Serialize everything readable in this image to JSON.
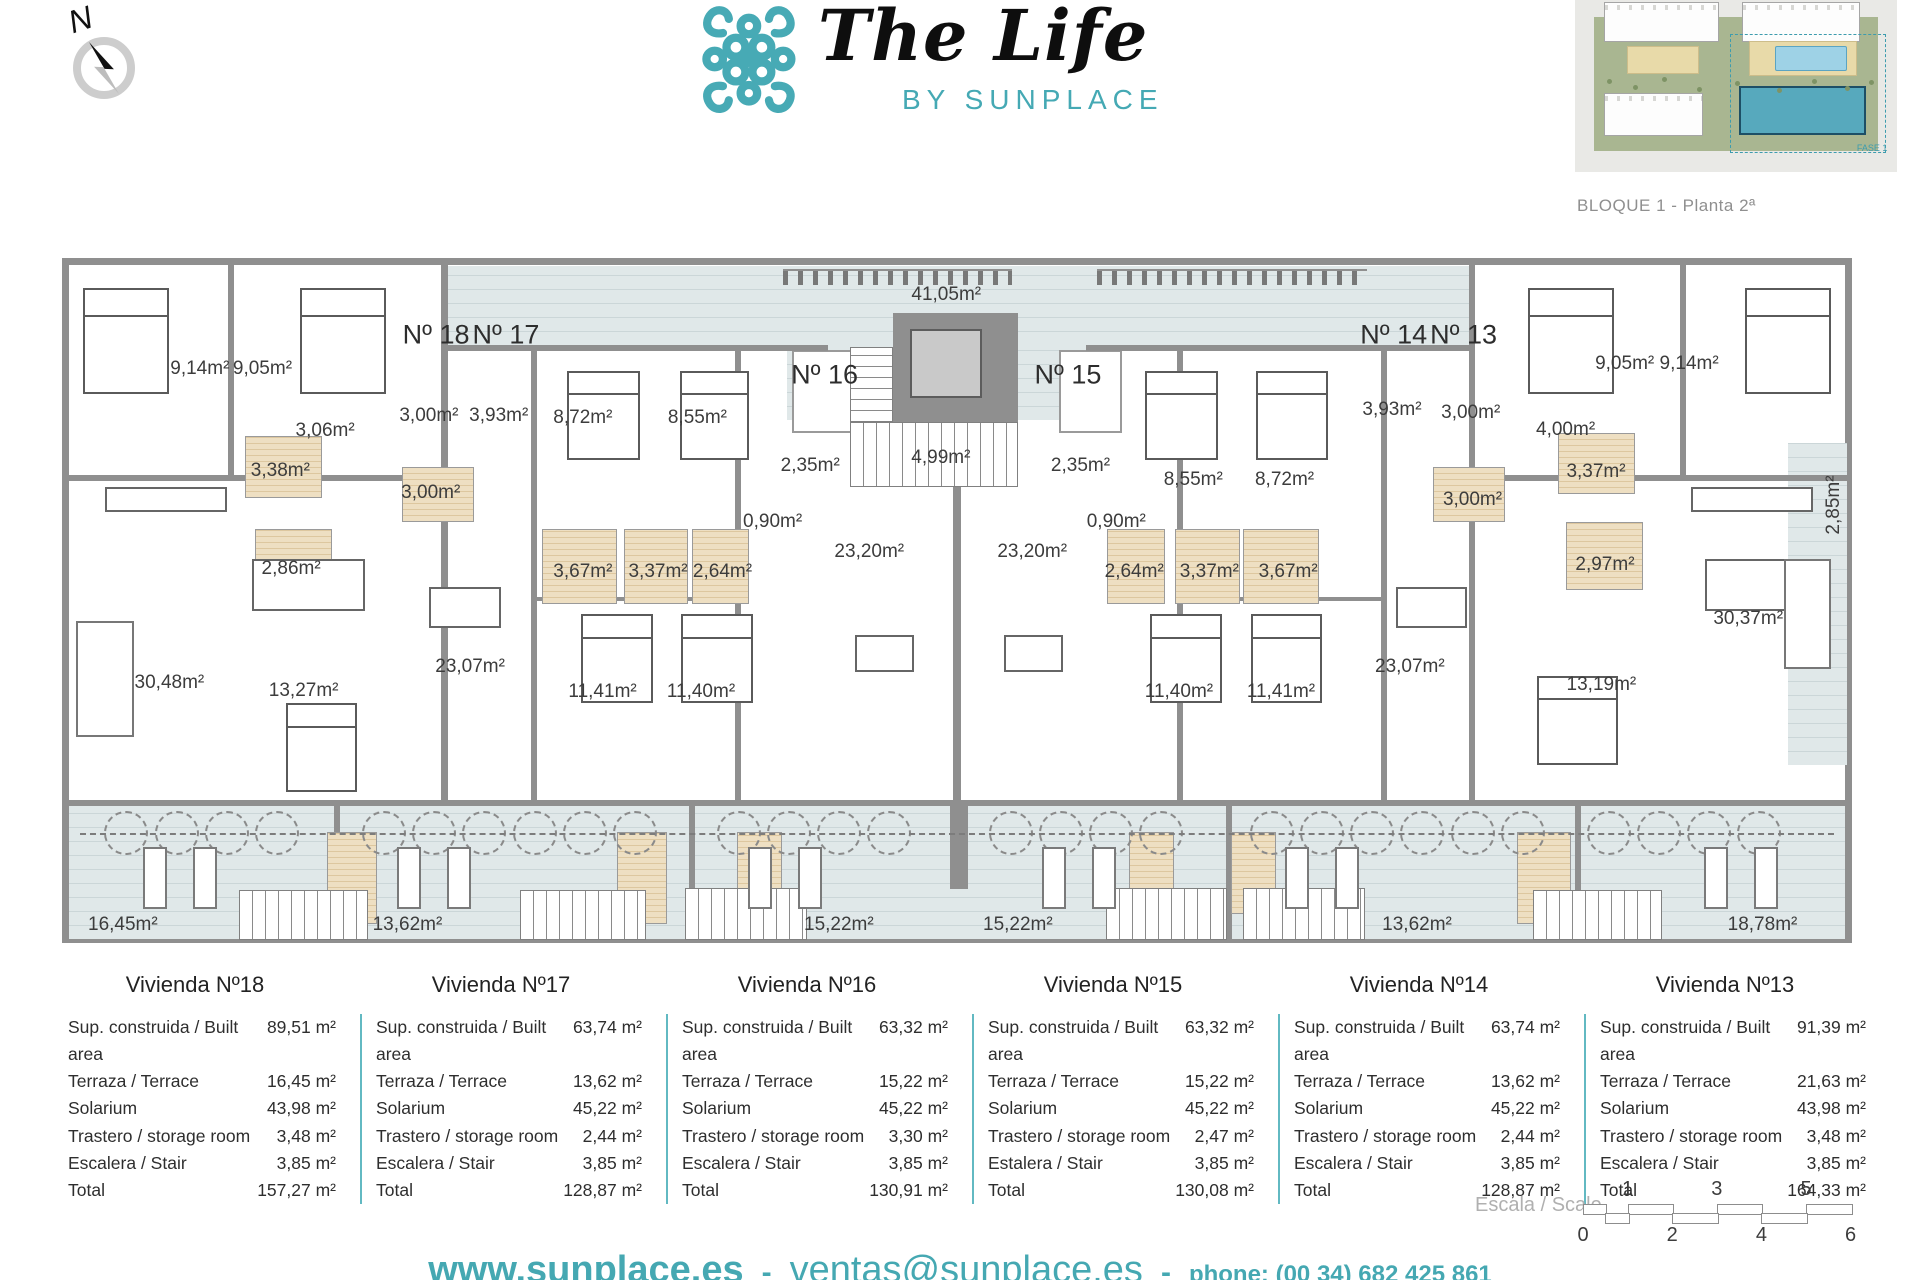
{
  "header": {
    "brand_script": "The Life",
    "brand_sub": "BY SUNPLACE",
    "compass_n": "N",
    "block_label": "BLOQUE 1 - Planta 2ª",
    "minimap_fase": "FASE 1"
  },
  "colors": {
    "accent_teal": "#45a8b2",
    "wall_gray": "#8f8f8f",
    "terrace_hatch": "#e0e8e9",
    "bathroom_beige": "#ecdcbd",
    "table_divider": "#62b9c2"
  },
  "plan": {
    "labels": [
      {
        "t": "Nº 18",
        "x": 20.9,
        "y": 11.2,
        "k": "apt"
      },
      {
        "t": "Nº 17",
        "x": 24.8,
        "y": 11.2,
        "k": "apt"
      },
      {
        "t": "Nº 16",
        "x": 42.6,
        "y": 17.1,
        "k": "apt"
      },
      {
        "t": "Nº 15",
        "x": 56.2,
        "y": 17.1,
        "k": "apt"
      },
      {
        "t": "Nº 14",
        "x": 74.4,
        "y": 11.2,
        "k": "apt"
      },
      {
        "t": "Nº 13",
        "x": 78.3,
        "y": 11.2,
        "k": "apt"
      },
      {
        "t": "41,05m²",
        "x": 49.4,
        "y": 5.4
      },
      {
        "t": "9,14m²",
        "x": 7.7,
        "y": 16.2
      },
      {
        "t": "9,05m²",
        "x": 11.2,
        "y": 16.2
      },
      {
        "t": "3,06m²",
        "x": 14.7,
        "y": 25.3
      },
      {
        "t": "3,00m²",
        "x": 20.5,
        "y": 23.0
      },
      {
        "t": "3,93m²",
        "x": 24.4,
        "y": 23.0
      },
      {
        "t": "8,72m²",
        "x": 29.1,
        "y": 23.4
      },
      {
        "t": "8,55m²",
        "x": 35.5,
        "y": 23.4
      },
      {
        "t": "3,38m²",
        "x": 12.2,
        "y": 31.1
      },
      {
        "t": "3,00m²",
        "x": 20.6,
        "y": 34.3
      },
      {
        "t": "2,86m²",
        "x": 12.8,
        "y": 45.4
      },
      {
        "t": "3,67m²",
        "x": 29.1,
        "y": 45.8
      },
      {
        "t": "3,37m²",
        "x": 33.3,
        "y": 45.8
      },
      {
        "t": "2,64m²",
        "x": 36.9,
        "y": 45.8
      },
      {
        "t": "0,90m²",
        "x": 39.7,
        "y": 38.5
      },
      {
        "t": "2,35m²",
        "x": 41.8,
        "y": 30.4
      },
      {
        "t": "4,99m²",
        "x": 49.1,
        "y": 29.2
      },
      {
        "t": "2,35m²",
        "x": 56.9,
        "y": 30.4
      },
      {
        "t": "0,90m²",
        "x": 58.9,
        "y": 38.5
      },
      {
        "t": "23,20m²",
        "x": 45.1,
        "y": 42.9
      },
      {
        "t": "23,20m²",
        "x": 54.2,
        "y": 42.9
      },
      {
        "t": "8,55m²",
        "x": 63.2,
        "y": 32.4
      },
      {
        "t": "8,72m²",
        "x": 68.3,
        "y": 32.4
      },
      {
        "t": "2,64m²",
        "x": 59.9,
        "y": 45.8
      },
      {
        "t": "3,37m²",
        "x": 64.1,
        "y": 45.8
      },
      {
        "t": "3,67m²",
        "x": 68.5,
        "y": 45.8
      },
      {
        "t": "3,93m²",
        "x": 74.3,
        "y": 22.2
      },
      {
        "t": "3,00m²",
        "x": 78.7,
        "y": 22.6
      },
      {
        "t": "4,00m²",
        "x": 84.0,
        "y": 25.1
      },
      {
        "t": "3,00m²",
        "x": 78.8,
        "y": 35.3
      },
      {
        "t": "3,37m²",
        "x": 85.7,
        "y": 31.2
      },
      {
        "t": "2,97m²",
        "x": 86.2,
        "y": 44.8
      },
      {
        "t": "9,05m²",
        "x": 87.3,
        "y": 15.5
      },
      {
        "t": "9,14m²",
        "x": 90.9,
        "y": 15.5
      },
      {
        "t": "2,85m²",
        "x": 99.0,
        "y": 36.0,
        "r": 1
      },
      {
        "t": "30,48m²",
        "x": 6.0,
        "y": 62.0
      },
      {
        "t": "13,27m²",
        "x": 13.5,
        "y": 63.2
      },
      {
        "t": "23,07m²",
        "x": 22.8,
        "y": 59.7
      },
      {
        "t": "11,41m²",
        "x": 30.2,
        "y": 63.4
      },
      {
        "t": "11,40m²",
        "x": 35.7,
        "y": 63.4
      },
      {
        "t": "11,40m²",
        "x": 62.4,
        "y": 63.4
      },
      {
        "t": "11,41m²",
        "x": 68.1,
        "y": 63.4
      },
      {
        "t": "23,07m²",
        "x": 75.3,
        "y": 59.7
      },
      {
        "t": "13,19m²",
        "x": 86.0,
        "y": 62.3
      },
      {
        "t": "30,37m²",
        "x": 94.2,
        "y": 52.7
      },
      {
        "t": "16,45m²",
        "x": 3.4,
        "y": 97.3
      },
      {
        "t": "13,62m²",
        "x": 19.3,
        "y": 97.3
      },
      {
        "t": "15,22m²",
        "x": 43.4,
        "y": 97.3
      },
      {
        "t": "15,22m²",
        "x": 53.4,
        "y": 97.3
      },
      {
        "t": "13,62m²",
        "x": 75.7,
        "y": 97.3
      },
      {
        "t": "18,78m²",
        "x": 95.0,
        "y": 97.3
      }
    ],
    "hatch": [
      [
        21.2,
        1.2,
        57.4,
        11.5
      ],
      [
        40.5,
        12.7,
        17.7,
        11.0
      ],
      [
        96.4,
        27.0,
        3.3,
        47.0
      ],
      [
        0.4,
        80.0,
        99.2,
        19.4
      ]
    ],
    "tickstrips": [
      [
        40.3,
        1.6,
        12.8,
        2.4
      ],
      [
        57.8,
        1.6,
        15.1,
        2.4
      ]
    ],
    "walls_v": [
      [
        21.2,
        0,
        0.34,
        79.1
      ],
      [
        9.3,
        0,
        0.3,
        31.7
      ],
      [
        90.4,
        0,
        0.3,
        31.7
      ],
      [
        26.2,
        12.7,
        0.34,
        66.4
      ],
      [
        37.6,
        12.7,
        0.34,
        66.4
      ],
      [
        62.3,
        12.7,
        0.34,
        66.4
      ],
      [
        73.7,
        12.7,
        0.34,
        66.4
      ],
      [
        78.6,
        0,
        0.34,
        79.1
      ],
      [
        49.8,
        27.0,
        0.4,
        52.1
      ],
      [
        15.2,
        79.1,
        0.34,
        20.9
      ],
      [
        35.0,
        79.1,
        0.34,
        20.9
      ],
      [
        65.0,
        79.1,
        0.34,
        20.9
      ],
      [
        84.5,
        79.1,
        0.34,
        20.9
      ],
      [
        49.6,
        79.1,
        1.0,
        13.0
      ]
    ],
    "walls_h": [
      [
        21.2,
        12.7,
        21.6,
        0.9
      ],
      [
        57.2,
        12.7,
        21.75,
        0.9
      ],
      [
        0,
        31.7,
        21.2,
        0.9
      ],
      [
        78.6,
        31.7,
        21.4,
        0.9
      ],
      [
        0,
        79.1,
        100,
        0.9
      ],
      [
        26.2,
        49.5,
        11.4,
        0.6
      ],
      [
        62.3,
        49.5,
        11.4,
        0.6
      ]
    ],
    "whiteboxes": [
      [
        40.8,
        13.5,
        3.5,
        12.0
      ],
      [
        55.7,
        13.5,
        3.5,
        12.0
      ]
    ],
    "core": {
      "box": [
        46.4,
        8.0,
        7.0,
        16.0
      ],
      "elevator": [
        47.4,
        10.4,
        4.0,
        10.0
      ],
      "stair_h": [
        44.0,
        13.0,
        2.4,
        11.0
      ],
      "stair_v": [
        44.0,
        24.0,
        9.4,
        9.5
      ]
    },
    "beige": [
      [
        10.2,
        26.0,
        4.3,
        9
      ],
      [
        19.0,
        30.5,
        4.0,
        8
      ],
      [
        10.8,
        39.5,
        4.3,
        10
      ],
      [
        26.8,
        39.5,
        4.2,
        11
      ],
      [
        31.4,
        39.5,
        3.6,
        11
      ],
      [
        35.2,
        39.5,
        3.2,
        11
      ],
      [
        58.4,
        39.5,
        3.2,
        11
      ],
      [
        62.2,
        39.5,
        3.6,
        11
      ],
      [
        66.0,
        39.5,
        4.2,
        11
      ],
      [
        76.6,
        30.5,
        4.0,
        8
      ],
      [
        83.6,
        25.5,
        4.3,
        9
      ],
      [
        84.0,
        38.5,
        4.3,
        10
      ],
      [
        14.8,
        83.8,
        2.8,
        13.5
      ],
      [
        31.0,
        83.8,
        2.8,
        13.5
      ],
      [
        37.7,
        83.8,
        2.5,
        12
      ],
      [
        59.6,
        83.8,
        2.5,
        12
      ],
      [
        65.3,
        83.8,
        2.5,
        12
      ],
      [
        81.3,
        83.8,
        3.0,
        13.5
      ]
    ],
    "bstairs": [
      [
        9.9,
        92.2,
        7.2,
        7.4
      ],
      [
        25.6,
        92.2,
        7.0,
        7.4
      ],
      [
        34.8,
        92.0,
        6.8,
        7.6
      ],
      [
        58.3,
        92.0,
        6.8,
        7.6
      ],
      [
        66.0,
        92.0,
        6.8,
        7.6
      ],
      [
        82.2,
        92.2,
        7.2,
        7.4
      ]
    ],
    "beds": [
      [
        1.2,
        4.4,
        4.8,
        15.5
      ],
      [
        13.3,
        4.4,
        4.8,
        15.5
      ],
      [
        81.9,
        4.4,
        4.8,
        15.5
      ],
      [
        94.0,
        4.4,
        4.8,
        15.5
      ],
      [
        28.2,
        16.5,
        4.1,
        13
      ],
      [
        34.5,
        16.5,
        3.9,
        13
      ],
      [
        60.5,
        16.5,
        4.1,
        13
      ],
      [
        66.7,
        16.5,
        4.0,
        13
      ],
      [
        29.0,
        52.0,
        4.0,
        13
      ],
      [
        34.6,
        52.0,
        4.0,
        13
      ],
      [
        60.8,
        52.0,
        4.0,
        13
      ],
      [
        66.4,
        52.0,
        4.0,
        13
      ],
      [
        12.5,
        65.0,
        4.0,
        13
      ],
      [
        82.4,
        61.0,
        4.5,
        13
      ]
    ],
    "dtables": [
      [
        10.6,
        44.0,
        6.3,
        7.5
      ],
      [
        91.8,
        44.0,
        5.2,
        7.5
      ],
      [
        20.5,
        48.0,
        4.0,
        6.0
      ],
      [
        74.5,
        48.0,
        4.0,
        6.0
      ],
      [
        44.3,
        55.0,
        3.3,
        5.5
      ],
      [
        52.6,
        55.0,
        3.3,
        5.5
      ]
    ],
    "counters": [
      [
        2.4,
        33.5,
        6.8,
        3.6
      ],
      [
        91.0,
        33.5,
        6.8,
        3.6
      ]
    ],
    "sofas": [
      [
        0.8,
        53.0,
        3.2,
        17.0
      ],
      [
        96.2,
        44.0,
        2.6,
        16.0
      ]
    ],
    "circles_y": 84.0,
    "circles_x": [
      3.6,
      6.4,
      9.2,
      12.0,
      18.0,
      20.8,
      23.6,
      26.4,
      29.2,
      32.0,
      37.8,
      40.6,
      43.4,
      46.2,
      53.0,
      55.8,
      58.6,
      61.4,
      67.6,
      70.4,
      73.2,
      76.0,
      78.8,
      81.6,
      86.4,
      89.2,
      92.0,
      94.8
    ],
    "loungers_y": 86.0,
    "loungers_x": [
      5.2,
      8.0,
      19.4,
      22.2,
      39.0,
      41.8,
      55.4,
      58.2,
      69.0,
      71.8,
      92.4,
      95.2
    ],
    "dashline": [
      1.0,
      84.0,
      98.0
    ]
  },
  "tables": {
    "items": [
      {
        "title": "Vivienda Nº18",
        "rows": [
          [
            "Sup. construida / Built area",
            "89,51 m²"
          ],
          [
            "Terraza / Terrace",
            "16,45 m²"
          ],
          [
            "Solarium",
            "43,98 m²"
          ],
          [
            "Trastero / storage room",
            "3,48 m²"
          ],
          [
            "Escalera / Stair",
            "3,85 m²"
          ],
          [
            "Total",
            "157,27 m²"
          ]
        ]
      },
      {
        "title": "Vivienda Nº17",
        "rows": [
          [
            "Sup. construida / Built area",
            "63,74 m²"
          ],
          [
            "Terraza / Terrace",
            "13,62 m²"
          ],
          [
            "Solarium",
            "45,22 m²"
          ],
          [
            "Trastero / storage room",
            "2,44 m²"
          ],
          [
            "Escalera / Stair",
            "3,85 m²"
          ],
          [
            "Total",
            "128,87 m²"
          ]
        ]
      },
      {
        "title": "Vivienda Nº16",
        "rows": [
          [
            "Sup. construida / Built area",
            "63,32 m²"
          ],
          [
            "Terraza / Terrace",
            "15,22 m²"
          ],
          [
            "Solarium",
            "45,22 m²"
          ],
          [
            "Trastero / storage room",
            "3,30 m²"
          ],
          [
            "Escalera / Stair",
            "3,85 m²"
          ],
          [
            "Total",
            "130,91 m²"
          ]
        ]
      },
      {
        "title": "Vivienda Nº15",
        "rows": [
          [
            "Sup. construida / Built area",
            "63,32 m²"
          ],
          [
            "Terraza / Terrace",
            "15,22 m²"
          ],
          [
            "Solarium",
            "45,22 m²"
          ],
          [
            "Trastero / storage room",
            "2,47 m²"
          ],
          [
            "Estalera / Stair",
            "3,85 m²"
          ],
          [
            "Total",
            "130,08 m²"
          ]
        ]
      },
      {
        "title": "Vivienda Nº14",
        "rows": [
          [
            "Sup. construida / Built area",
            "63,74 m²"
          ],
          [
            "Terraza / Terrace",
            "13,62 m²"
          ],
          [
            "Solarium",
            "45,22 m²"
          ],
          [
            "Trastero / storage room",
            "2,44 m²"
          ],
          [
            "Escalera / Stair",
            "3,85 m²"
          ],
          [
            "Total",
            "128,87 m²"
          ]
        ]
      },
      {
        "title": "Vivienda Nº13",
        "rows": [
          [
            "Sup. construida / Built area",
            "91,39 m²"
          ],
          [
            "Terraza / Terrace",
            "21,63 m²"
          ],
          [
            "Solarium",
            "43,98 m²"
          ],
          [
            "Trastero / storage room",
            "3,48 m²"
          ],
          [
            "Escalera / Stair",
            "3,85 m²"
          ],
          [
            "Total",
            "164,33 m²"
          ]
        ]
      }
    ]
  },
  "scalebar": {
    "label": "Escala / Scale",
    "top": [
      "1",
      "3",
      "5"
    ],
    "bottom": [
      "0",
      "2",
      "4",
      "6"
    ]
  },
  "footer": {
    "web": "www.sunplace.es",
    "sep": "-",
    "email": "ventas@sunplace.es",
    "phone": "phone: (00 34) 682 425 861"
  }
}
